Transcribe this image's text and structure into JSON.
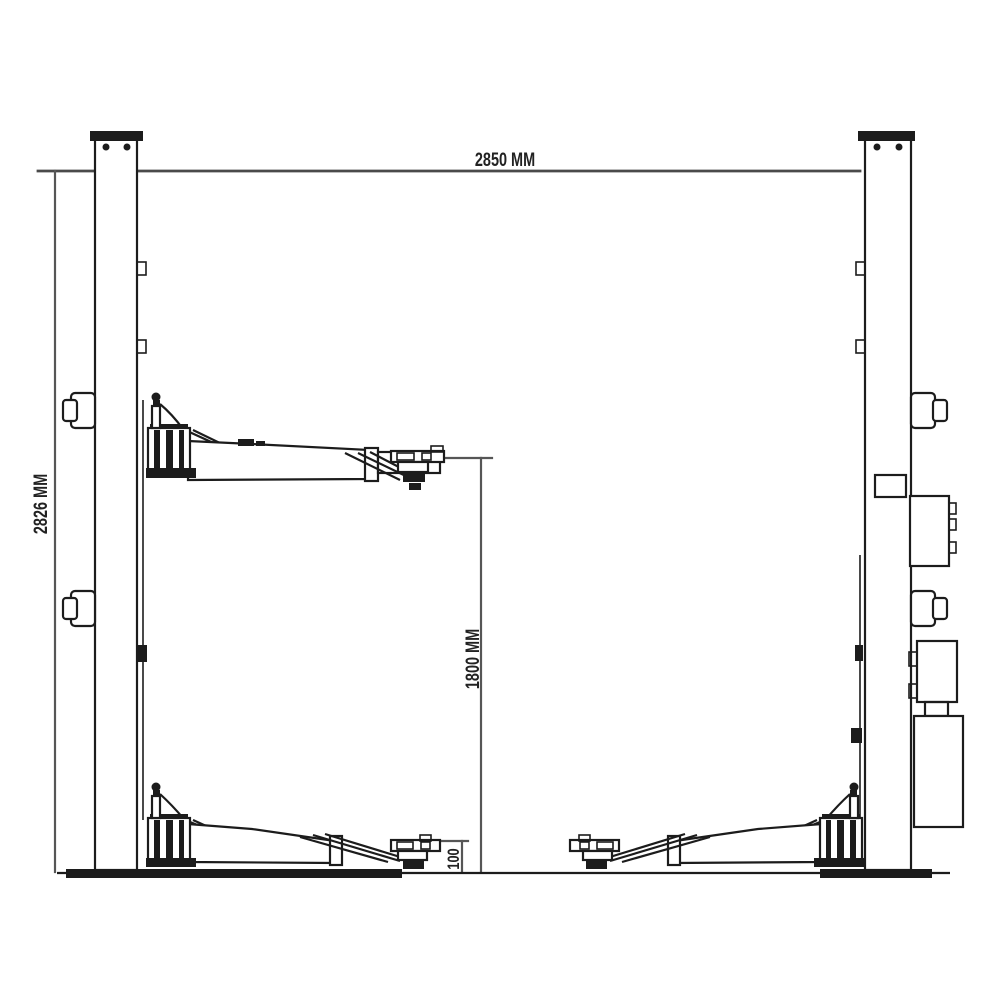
{
  "drawing": {
    "labels": {
      "overall_width": "2850 MM",
      "overall_height": "2826 MM",
      "lift_height": "1800 MM",
      "pad_min_height": "100"
    },
    "colors": {
      "background": "#ffffff",
      "outline": "#1c1c1c",
      "dimension_line": "#565656",
      "label_text": "#222222"
    }
  }
}
